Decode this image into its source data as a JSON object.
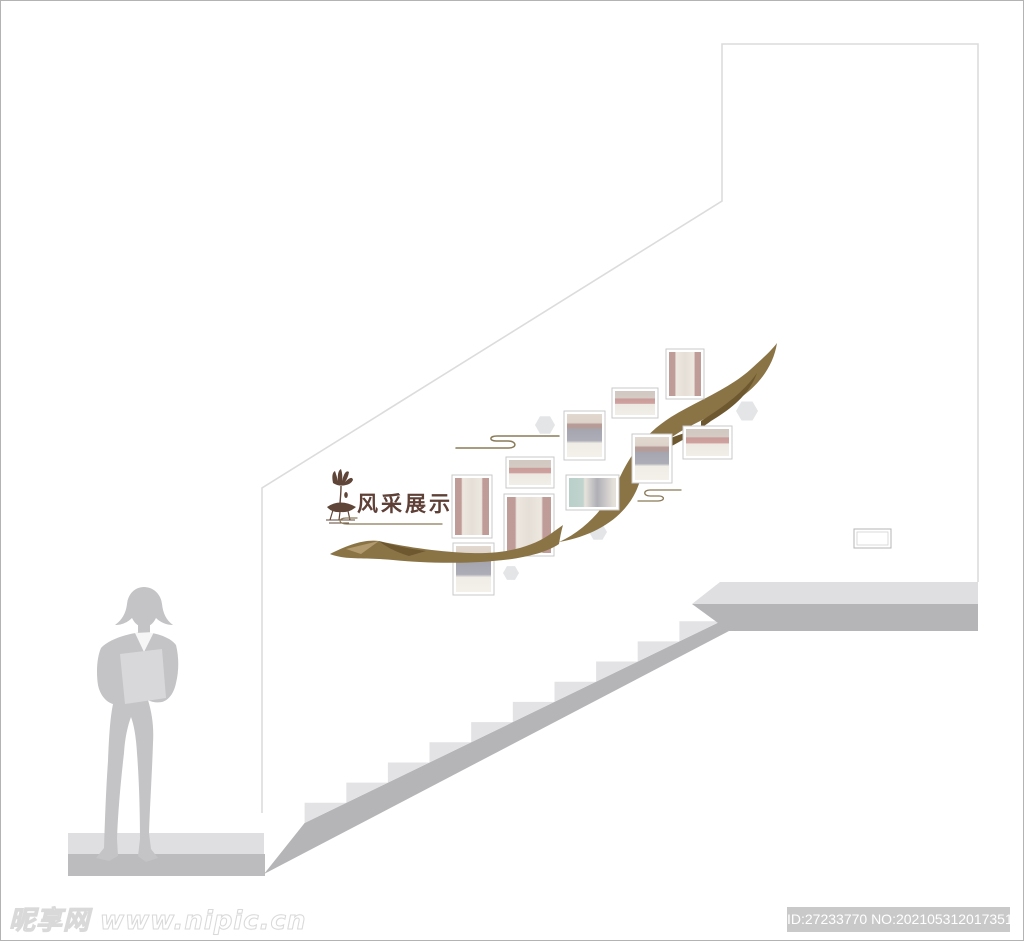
{
  "canvas": {
    "width": 1024,
    "height": 941,
    "background": "#ffffff",
    "border_color": "#b3b3b3"
  },
  "wall_design": {
    "heading": {
      "text": "风采展示",
      "color": "#5e4037"
    },
    "lotus_icon_color": "#5f4537",
    "ribbon": {
      "main_color": "#8a7446",
      "dark_color": "#6e5830",
      "light_color": "#b39a6e"
    },
    "cloud_motif_color": "#8a7a58",
    "hexagon_color": "#e3e5e7",
    "photo_frames": {
      "count": 10,
      "frame_color": "#ffffff",
      "frame_border_color": "#c9c9c9"
    }
  },
  "structure": {
    "wall_line_color": "#dcdcdc",
    "stairs": {
      "step_light": "#e3e3e5",
      "band_dark": "#b5b5b8",
      "floor_light": "#dfdfe1",
      "floor_dark": "#bcbcbf"
    },
    "switch_plate_border": "#b5b5b5"
  },
  "silhouette": {
    "body_color": "#c4c4c7",
    "folder_color": "#d8d8db"
  },
  "watermark": {
    "text": "昵享网 www.nipic.cn"
  },
  "footer_id": {
    "text": "ID:27233770 NO:20210531201735188128",
    "background": "#c9c9c9",
    "color": "#ffffff"
  }
}
